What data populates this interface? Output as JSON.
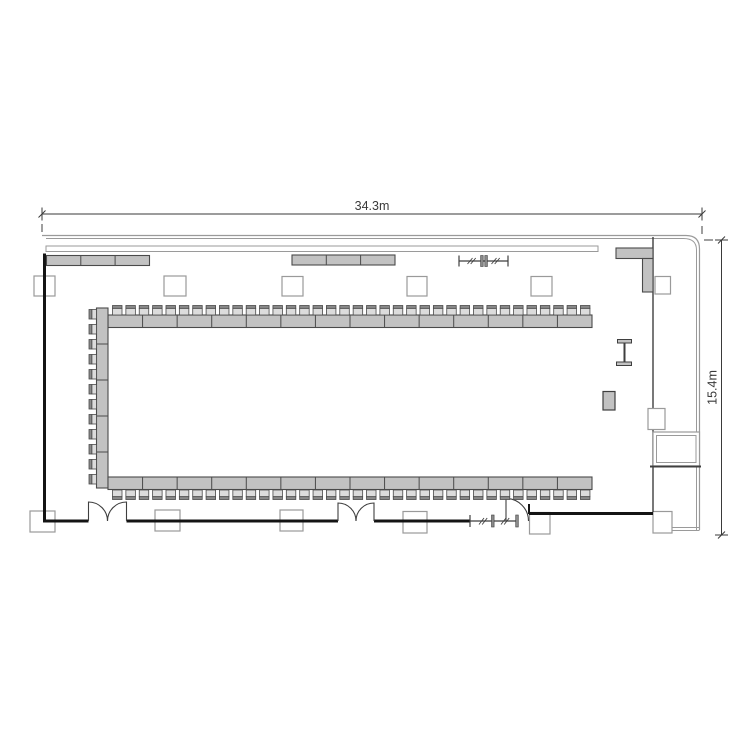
{
  "title": "Banquet hall floor plan with U-shaped conference seating",
  "dimensions": {
    "width_label": "34.3m",
    "height_label": "15.4m"
  },
  "colors": {
    "wall": "#141414",
    "mid": "#3f3f3f",
    "thin": "#9a9a9a",
    "furn": "#c2c2c2",
    "fstroke": "#4a4a4a",
    "chair": "#dcdcdc",
    "back": "#8a8a8a",
    "col": "#9a9a9a",
    "white": "#ffffff",
    "dim": "#3a3a3a",
    "none": "none"
  },
  "plan": {
    "width": 750,
    "height": 750,
    "shapes": [
      {
        "t": "line",
        "name": "dim-width-line",
        "x1": 42,
        "y1": 214,
        "x2": 702,
        "y2": 214,
        "c": "dim",
        "w": 1
      },
      {
        "t": "line",
        "name": "dim-width-tick-left",
        "x1": 42,
        "y1": 207.5,
        "x2": 42,
        "y2": 220.5,
        "c": "dim",
        "w": 1
      },
      {
        "t": "line",
        "name": "dim-width-tick-right",
        "x1": 702,
        "y1": 207.5,
        "x2": 702,
        "y2": 220.5,
        "c": "dim",
        "w": 1
      },
      {
        "t": "line",
        "name": "dim-width-oblique-left",
        "x1": 38.5,
        "y1": 217.5,
        "x2": 45.5,
        "y2": 210.5,
        "c": "dim",
        "w": 1
      },
      {
        "t": "line",
        "name": "dim-width-oblique-right",
        "x1": 698.5,
        "y1": 217.5,
        "x2": 705.5,
        "y2": 210.5,
        "c": "dim",
        "w": 1
      },
      {
        "t": "line",
        "name": "dim-width-ext-left",
        "x1": 42,
        "y1": 224,
        "x2": 42,
        "y2": 232,
        "c": "mid",
        "w": 1
      },
      {
        "t": "line",
        "name": "dim-width-ext-right",
        "x1": 702,
        "y1": 226,
        "x2": 702,
        "y2": 234,
        "c": "mid",
        "w": 1
      },
      {
        "t": "text",
        "name": "dim-width-label",
        "x": 372,
        "y": 210,
        "size": 12.5,
        "c": "dim",
        "bind": "dimensions.width_label"
      },
      {
        "t": "line",
        "name": "dim-height-line",
        "x1": 721.5,
        "y1": 240,
        "x2": 721.5,
        "y2": 535,
        "c": "dim",
        "w": 1
      },
      {
        "t": "line",
        "name": "dim-height-tick-top",
        "x1": 715,
        "y1": 240,
        "x2": 728,
        "y2": 240,
        "c": "dim",
        "w": 1
      },
      {
        "t": "line",
        "name": "dim-height-tick-bottom",
        "x1": 715,
        "y1": 535,
        "x2": 728,
        "y2": 535,
        "c": "dim",
        "w": 1
      },
      {
        "t": "line",
        "name": "dim-height-oblique-top",
        "x1": 718,
        "y1": 243.5,
        "x2": 725,
        "y2": 236.5,
        "c": "dim",
        "w": 1
      },
      {
        "t": "line",
        "name": "dim-height-oblique-bottom",
        "x1": 718,
        "y1": 538.5,
        "x2": 725,
        "y2": 531.5,
        "c": "dim",
        "w": 1
      },
      {
        "t": "line",
        "name": "dim-height-ext-top",
        "x1": 704,
        "y1": 240,
        "x2": 713,
        "y2": 240,
        "c": "mid",
        "w": 1
      },
      {
        "t": "text",
        "name": "dim-height-label",
        "x": 716.5,
        "y": 387.5,
        "size": 12.5,
        "c": "dim",
        "rotate": -90,
        "bind": "dimensions.height_label"
      },
      {
        "t": "path",
        "name": "outer-wall-outer",
        "d": "M42 235.5 H686 Q699.5 235.5 699.5 249 V530",
        "c": "thin",
        "f": "none",
        "w": 1.2
      },
      {
        "t": "path",
        "name": "outer-wall-inner",
        "d": "M46 238.5 H683.5 Q696.5 238.5 696.5 250 V530",
        "c": "thin",
        "f": "none",
        "w": 1
      },
      {
        "t": "line",
        "name": "outer-wall-bottom-a",
        "x1": 672,
        "y1": 527.5,
        "x2": 699.5,
        "y2": 527.5,
        "c": "thin",
        "w": 1
      },
      {
        "t": "line",
        "name": "outer-wall-bottom-b",
        "x1": 672,
        "y1": 530.5,
        "x2": 699.5,
        "y2": 530.5,
        "c": "thin",
        "w": 1
      },
      {
        "t": "rect",
        "name": "window-band",
        "x": 46,
        "y": 246,
        "w": 552,
        "h": 5.5,
        "f": "white",
        "c": "thin",
        "sw": 1
      },
      {
        "t": "rect",
        "name": "column",
        "x": 34,
        "y": 276,
        "w": 21,
        "h": 20,
        "f": "white",
        "c": "col",
        "sw": 1.2
      },
      {
        "t": "rect",
        "name": "column",
        "x": 164,
        "y": 276,
        "w": 22,
        "h": 20,
        "f": "white",
        "c": "col",
        "sw": 1.2
      },
      {
        "t": "rect",
        "name": "column",
        "x": 282,
        "y": 276.5,
        "w": 21,
        "h": 19.5,
        "f": "white",
        "c": "col",
        "sw": 1.2
      },
      {
        "t": "rect",
        "name": "column",
        "x": 407,
        "y": 276.5,
        "w": 20,
        "h": 19.5,
        "f": "white",
        "c": "col",
        "sw": 1.2
      },
      {
        "t": "rect",
        "name": "column",
        "x": 531,
        "y": 276.5,
        "w": 21,
        "h": 19.5,
        "f": "white",
        "c": "col",
        "sw": 1.2
      },
      {
        "t": "rect",
        "name": "column",
        "x": 655,
        "y": 276.5,
        "w": 15.5,
        "h": 17.5,
        "f": "white",
        "c": "col",
        "sw": 1.2
      },
      {
        "t": "rect",
        "name": "column",
        "x": 30,
        "y": 511,
        "w": 25,
        "h": 21,
        "f": "white",
        "c": "col",
        "sw": 1.2
      },
      {
        "t": "rect",
        "name": "column",
        "x": 155,
        "y": 510,
        "w": 25,
        "h": 21,
        "f": "white",
        "c": "col",
        "sw": 1.2
      },
      {
        "t": "rect",
        "name": "column",
        "x": 280,
        "y": 510,
        "w": 23,
        "h": 21,
        "f": "white",
        "c": "col",
        "sw": 1.2
      },
      {
        "t": "rect",
        "name": "column",
        "x": 403,
        "y": 511.5,
        "w": 24,
        "h": 21.5,
        "f": "white",
        "c": "col",
        "sw": 1.2
      },
      {
        "t": "rect",
        "name": "column",
        "x": 529.5,
        "y": 512.5,
        "w": 20.5,
        "h": 21.5,
        "f": "white",
        "c": "col",
        "sw": 1.2
      },
      {
        "t": "rect",
        "name": "column",
        "x": 653,
        "y": 511.5,
        "w": 19,
        "h": 21.5,
        "f": "white",
        "c": "col",
        "sw": 1.2
      },
      {
        "t": "line",
        "name": "wall-left",
        "x1": 44.5,
        "y1": 253.5,
        "x2": 44.5,
        "y2": 521,
        "c": "wall",
        "w": 3
      },
      {
        "t": "line",
        "name": "wall-bottom-1",
        "x1": 43,
        "y1": 521,
        "x2": 88.5,
        "y2": 521,
        "c": "wall",
        "w": 3
      },
      {
        "t": "line",
        "name": "wall-bottom-2",
        "x1": 126.5,
        "y1": 521,
        "x2": 338,
        "y2": 521,
        "c": "wall",
        "w": 3
      },
      {
        "t": "line",
        "name": "wall-bottom-3",
        "x1": 374,
        "y1": 521,
        "x2": 470,
        "y2": 521,
        "c": "wall",
        "w": 3
      },
      {
        "t": "line",
        "name": "wall-bottom-4",
        "x1": 529,
        "y1": 513.5,
        "x2": 653,
        "y2": 513.5,
        "c": "wall",
        "w": 3
      },
      {
        "t": "line",
        "name": "wall-door-jamb",
        "x1": 529,
        "y1": 504,
        "x2": 529,
        "y2": 514,
        "c": "wall",
        "w": 2
      },
      {
        "t": "line",
        "name": "interior-wall-right",
        "x1": 653,
        "y1": 237,
        "x2": 653,
        "y2": 512,
        "c": "mid",
        "w": 1.4
      },
      {
        "t": "path",
        "name": "double-door-left-leaf-a",
        "d": "M88.5 521 V502 A19 19 0 0 1 107.5 521",
        "c": "mid",
        "f": "none",
        "w": 1.1
      },
      {
        "t": "path",
        "name": "double-door-left-leaf-b",
        "d": "M126.5 521 V502 A19 19 0 0 0 107.5 521",
        "c": "mid",
        "f": "none",
        "w": 1.1
      },
      {
        "t": "path",
        "name": "double-door-mid-leaf-a",
        "d": "M338 521 V503 A18 18 0 0 1 356 521",
        "c": "mid",
        "f": "none",
        "w": 1.1
      },
      {
        "t": "path",
        "name": "double-door-mid-leaf-b",
        "d": "M374 521 V503 A18 18 0 0 0 356 521",
        "c": "mid",
        "f": "none",
        "w": 1.1
      },
      {
        "t": "path",
        "name": "single-door",
        "d": "M506 521 V498.5 A22.5 22.5 0 0 1 528.5 521",
        "c": "mid",
        "f": "none",
        "w": 1.1
      },
      {
        "t": "line",
        "name": "partition-top-rail",
        "x1": 459,
        "y1": 261,
        "x2": 508,
        "y2": 261,
        "c": "mid",
        "w": 1.2
      },
      {
        "t": "line",
        "name": "partition-top-end-left",
        "x1": 459,
        "y1": 255.5,
        "x2": 459,
        "y2": 266.5,
        "c": "mid",
        "w": 1.2
      },
      {
        "t": "line",
        "name": "partition-top-end-right",
        "x1": 508,
        "y1": 255.5,
        "x2": 508,
        "y2": 266.5,
        "c": "mid",
        "w": 1.2
      },
      {
        "t": "rect",
        "name": "partition-top-stack",
        "x": 480.6,
        "y": 255.5,
        "w": 2.6,
        "h": 11,
        "f": "back",
        "c": "mid",
        "sw": 0.6
      },
      {
        "t": "rect",
        "name": "partition-top-stack",
        "x": 484.8,
        "y": 255.5,
        "w": 2.6,
        "h": 11,
        "f": "back",
        "c": "mid",
        "sw": 0.6
      },
      {
        "t": "ticks",
        "name": "partition-top-hash",
        "x1": 467.5,
        "y1": 264,
        "x2": 472.5,
        "y2": 258,
        "dx": 3.2,
        "dy": 0,
        "n": 2,
        "c": "mid",
        "w": 0.9
      },
      {
        "t": "ticks",
        "name": "partition-top-hash",
        "x1": 491.5,
        "y1": 264,
        "x2": 496.5,
        "y2": 258,
        "dx": 3.2,
        "dy": 0,
        "n": 2,
        "c": "mid",
        "w": 0.9
      },
      {
        "t": "line",
        "name": "partition-bottom-rail",
        "x1": 470,
        "y1": 521,
        "x2": 517,
        "y2": 521,
        "c": "mid",
        "w": 1.2
      },
      {
        "t": "line",
        "name": "partition-bottom-end-left",
        "x1": 470,
        "y1": 515,
        "x2": 470,
        "y2": 527,
        "c": "mid",
        "w": 1.2
      },
      {
        "t": "rect",
        "name": "partition-bottom-stack",
        "x": 491.5,
        "y": 515,
        "w": 2.6,
        "h": 12,
        "f": "back",
        "c": "mid",
        "sw": 0.6
      },
      {
        "t": "rect",
        "name": "partition-bottom-stack",
        "x": 515.7,
        "y": 515,
        "w": 2.6,
        "h": 12,
        "f": "back",
        "c": "mid",
        "sw": 0.6
      },
      {
        "t": "ticks",
        "name": "partition-bottom-hash",
        "x1": 479,
        "y1": 524.5,
        "x2": 484,
        "y2": 518,
        "dx": 3.2,
        "dy": 0,
        "n": 2,
        "c": "mid",
        "w": 0.9
      },
      {
        "t": "ticks",
        "name": "partition-bottom-hash",
        "x1": 501,
        "y1": 524.5,
        "x2": 506,
        "y2": 518,
        "dx": 3.2,
        "dy": 0,
        "n": 2,
        "c": "mid",
        "w": 0.9
      },
      {
        "t": "rect",
        "name": "shaft-outer",
        "x": 653,
        "y": 432,
        "w": 46.5,
        "h": 34,
        "f": "white",
        "c": "thin",
        "sw": 1.2
      },
      {
        "t": "rect",
        "name": "shaft-inner",
        "x": 656.5,
        "y": 435.5,
        "w": 39.5,
        "h": 27,
        "f": "none",
        "c": "thin",
        "sw": 1
      },
      {
        "t": "line",
        "name": "shaft-bottom-edge",
        "x1": 650,
        "y1": 466.5,
        "x2": 701,
        "y2": 466.5,
        "c": "mid",
        "w": 2
      },
      {
        "t": "rect",
        "name": "column",
        "x": 648,
        "y": 408.5,
        "w": 17,
        "h": 21,
        "f": "white",
        "c": "col",
        "sw": 1.2
      },
      {
        "t": "rect",
        "name": "counter",
        "x": 46.5,
        "y": 255.5,
        "w": 103,
        "h": 10,
        "f": "furn",
        "c": "fstroke",
        "sw": 1.1
      },
      {
        "t": "ticks",
        "name": "counter-divider",
        "x1": 80.8,
        "y1": 255.5,
        "x2": 80.8,
        "y2": 265.5,
        "dx": 34.3,
        "dy": 0,
        "n": 2,
        "c": "fstroke",
        "w": 1
      },
      {
        "t": "rect",
        "name": "counter",
        "x": 292,
        "y": 255,
        "w": 103,
        "h": 10,
        "f": "furn",
        "c": "fstroke",
        "sw": 1.1
      },
      {
        "t": "ticks",
        "name": "counter-divider",
        "x1": 326.3,
        "y1": 255,
        "x2": 326.3,
        "y2": 265,
        "dx": 34.3,
        "dy": 0,
        "n": 2,
        "c": "fstroke",
        "w": 1
      },
      {
        "t": "rect",
        "name": "corner-counter-h",
        "x": 616,
        "y": 248,
        "w": 37,
        "h": 10.5,
        "f": "furn",
        "c": "fstroke",
        "sw": 1.1
      },
      {
        "t": "rect",
        "name": "corner-counter-v",
        "x": 642.5,
        "y": 258.5,
        "w": 10.5,
        "h": 33.5,
        "f": "furn",
        "c": "fstroke",
        "sw": 1.1
      },
      {
        "t": "rect",
        "name": "table-run-top",
        "x": 108,
        "y": 315,
        "w": 484,
        "h": 12.5,
        "f": "furn",
        "c": "fstroke",
        "sw": 1.1
      },
      {
        "t": "ticks",
        "name": "table-divider",
        "x1": 142.57,
        "y1": 315,
        "x2": 142.57,
        "y2": 327.5,
        "dx": 34.57,
        "dy": 0,
        "n": 13,
        "c": "fstroke",
        "w": 1
      },
      {
        "t": "rect",
        "name": "table-run-left",
        "x": 96.5,
        "y": 308,
        "w": 11.5,
        "h": 180,
        "f": "furn",
        "c": "fstroke",
        "sw": 1.1
      },
      {
        "t": "ticks",
        "name": "table-divider",
        "x1": 96.5,
        "y1": 344,
        "x2": 108,
        "y2": 344,
        "dx": 0,
        "dy": 36,
        "n": 4,
        "c": "fstroke",
        "w": 1
      },
      {
        "t": "rect",
        "name": "table-run-bottom",
        "x": 108,
        "y": 477,
        "w": 484,
        "h": 12.5,
        "f": "furn",
        "c": "fstroke",
        "sw": 1.1
      },
      {
        "t": "ticks",
        "name": "table-divider",
        "x1": 142.57,
        "y1": 477,
        "x2": 142.57,
        "y2": 489.5,
        "dx": 34.57,
        "dy": 0,
        "n": 13,
        "c": "fstroke",
        "w": 1
      },
      {
        "t": "chairs",
        "name": "chair-row-top",
        "x": 112.5,
        "y": 305.5,
        "n": 36,
        "pitch": 13.37,
        "dir": "up",
        "cw": 9.5,
        "ch": 9.5
      },
      {
        "t": "chairs",
        "name": "chair-row-bottom",
        "x": 112.5,
        "y": 490,
        "n": 36,
        "pitch": 13.37,
        "dir": "down",
        "cw": 9.5,
        "ch": 9.5
      },
      {
        "t": "chairs",
        "name": "chair-col-left",
        "x": 89,
        "y": 309.5,
        "n": 12,
        "pitch": 15,
        "dir": "left",
        "cw": 7.5,
        "ch": 9.5
      },
      {
        "t": "rect",
        "name": "screen-cap-top",
        "x": 617.5,
        "y": 339.5,
        "w": 14,
        "h": 3.5,
        "f": "furn",
        "c": "mid",
        "sw": 1
      },
      {
        "t": "rect",
        "name": "screen-cap-bottom",
        "x": 616.5,
        "y": 362,
        "w": 15,
        "h": 3.5,
        "f": "furn",
        "c": "mid",
        "sw": 1
      },
      {
        "t": "line",
        "name": "screen-post",
        "x1": 624.5,
        "y1": 343,
        "x2": 624.5,
        "y2": 362,
        "c": "mid",
        "w": 2
      },
      {
        "t": "rect",
        "name": "equipment-stand",
        "x": 603,
        "y": 391.5,
        "w": 12,
        "h": 18.5,
        "f": "furn",
        "c": "mid",
        "sw": 1.2
      }
    ]
  }
}
